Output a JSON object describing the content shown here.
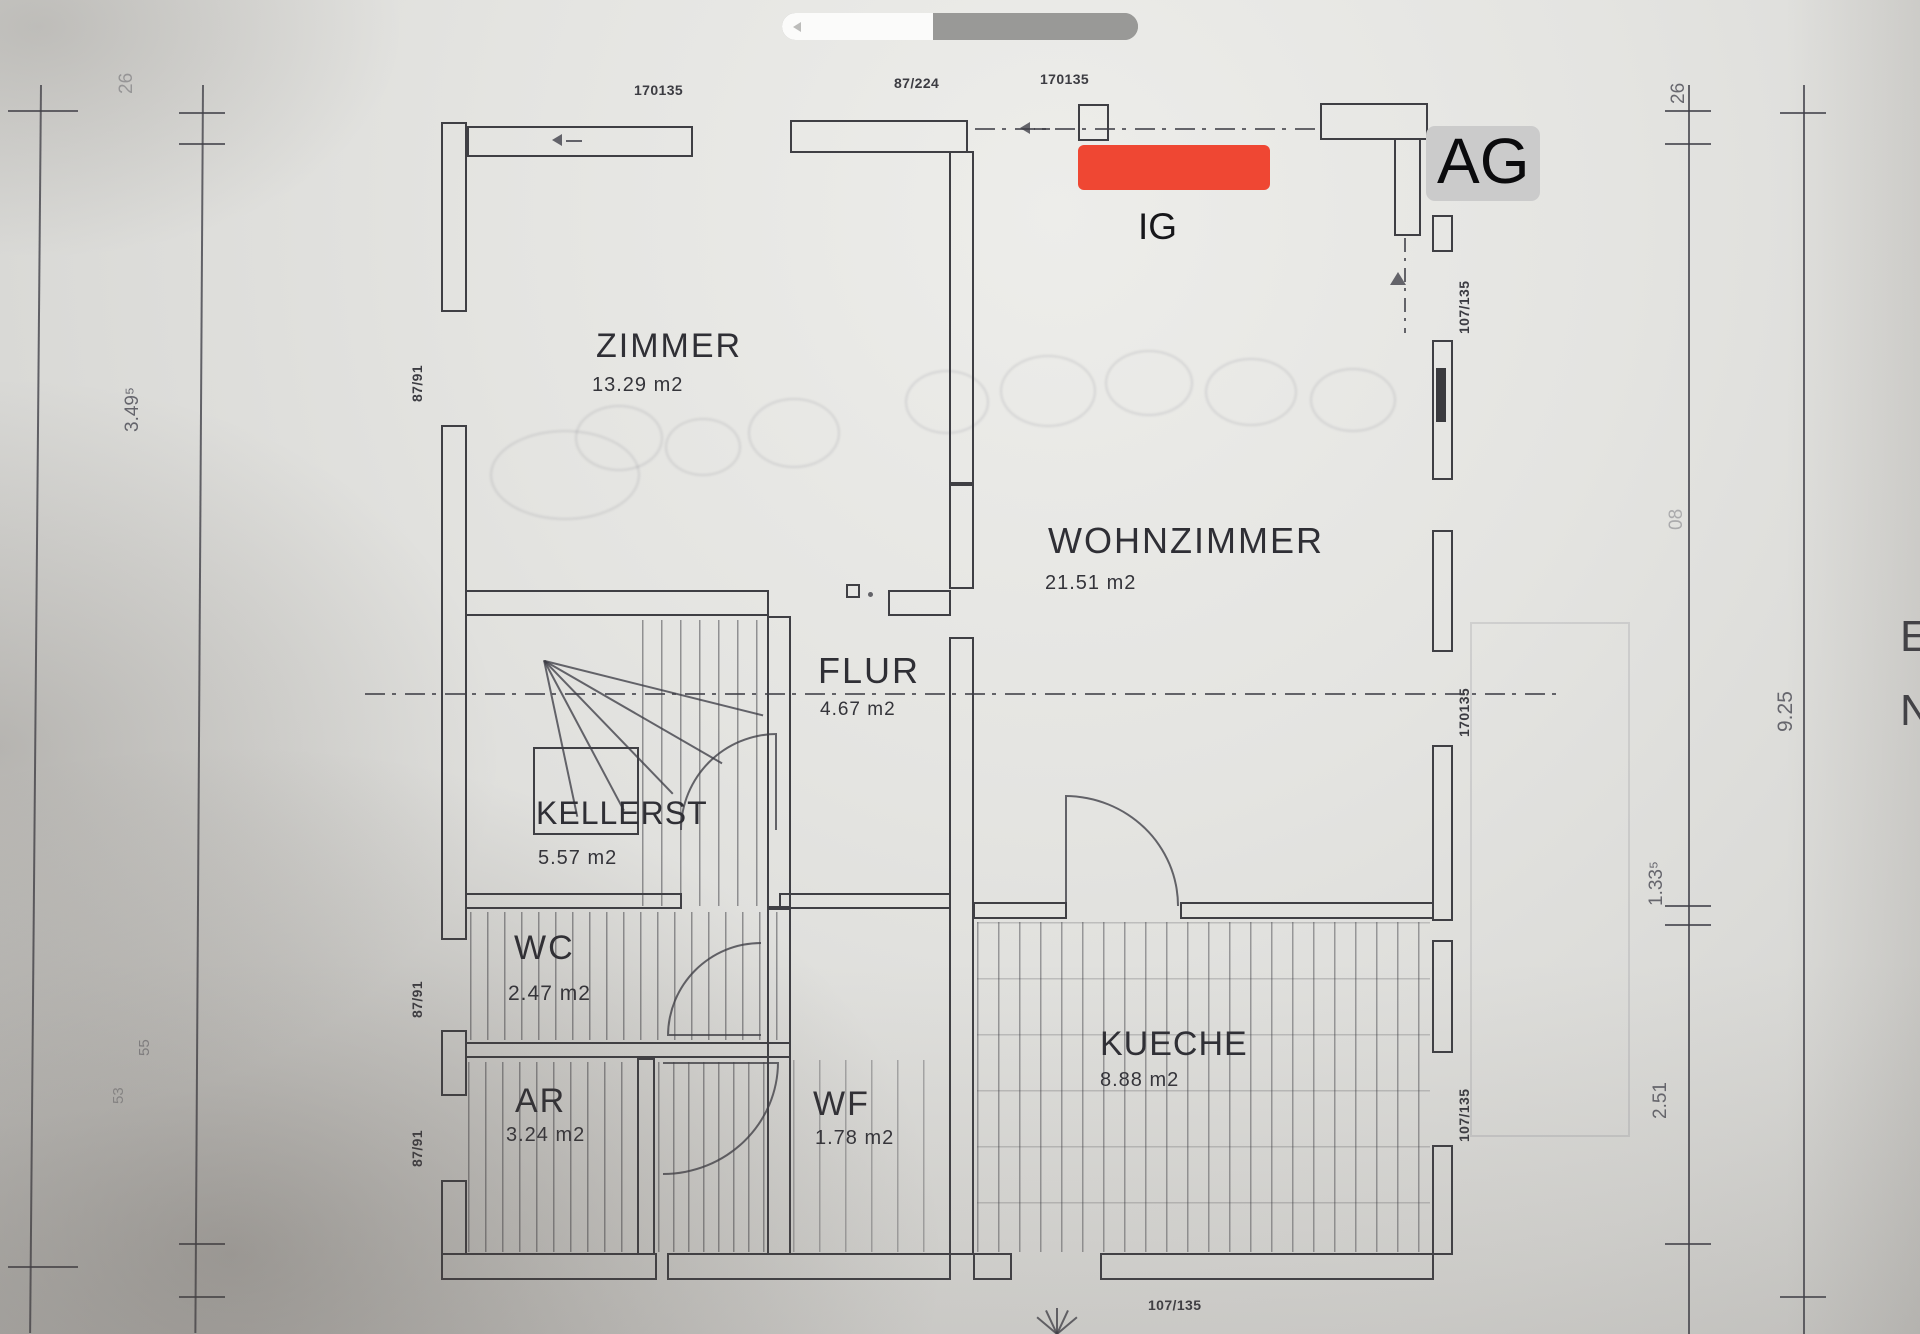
{
  "photo": {
    "paper_color": "#e4e4e1",
    "ink_color": "#3f3f44"
  },
  "overlay": {
    "ag_label": "AG",
    "ig_label": "IG",
    "redaction_color": "#ef4733",
    "ag_bg_color": "#cbcbcb",
    "scrubber_track_color": "#999997",
    "scrubber_fill_color": "#fbfbfa"
  },
  "rooms": [
    {
      "name": "ZIMMER",
      "area": "13.29 m2"
    },
    {
      "name": "WOHNZIMMER",
      "area": "21.51 m2"
    },
    {
      "name": "FLUR",
      "area": "4.67 m2"
    },
    {
      "name": "KELLERST",
      "area": "5.57 m2"
    },
    {
      "name": "WC",
      "area": "2.47 m2"
    },
    {
      "name": "AR",
      "area": "3.24 m2"
    },
    {
      "name": "WF",
      "area": "1.78 m2"
    },
    {
      "name": "KUECHE",
      "area": "8.88 m2"
    }
  ],
  "dims": {
    "top": [
      "170135",
      "87/224",
      "170135"
    ],
    "left_wall": [
      "87/91",
      "87/91",
      "87/91"
    ],
    "right_wall": [
      "107/135",
      "170135",
      "107/135"
    ],
    "bottom": "107/135",
    "site_right": [
      "26",
      "9.25",
      "1.33⁵",
      "2.51",
      "08"
    ],
    "site_left": [
      "26",
      "3.49⁵",
      "55",
      "53"
    ],
    "edge_letters": [
      "E",
      "N"
    ]
  }
}
